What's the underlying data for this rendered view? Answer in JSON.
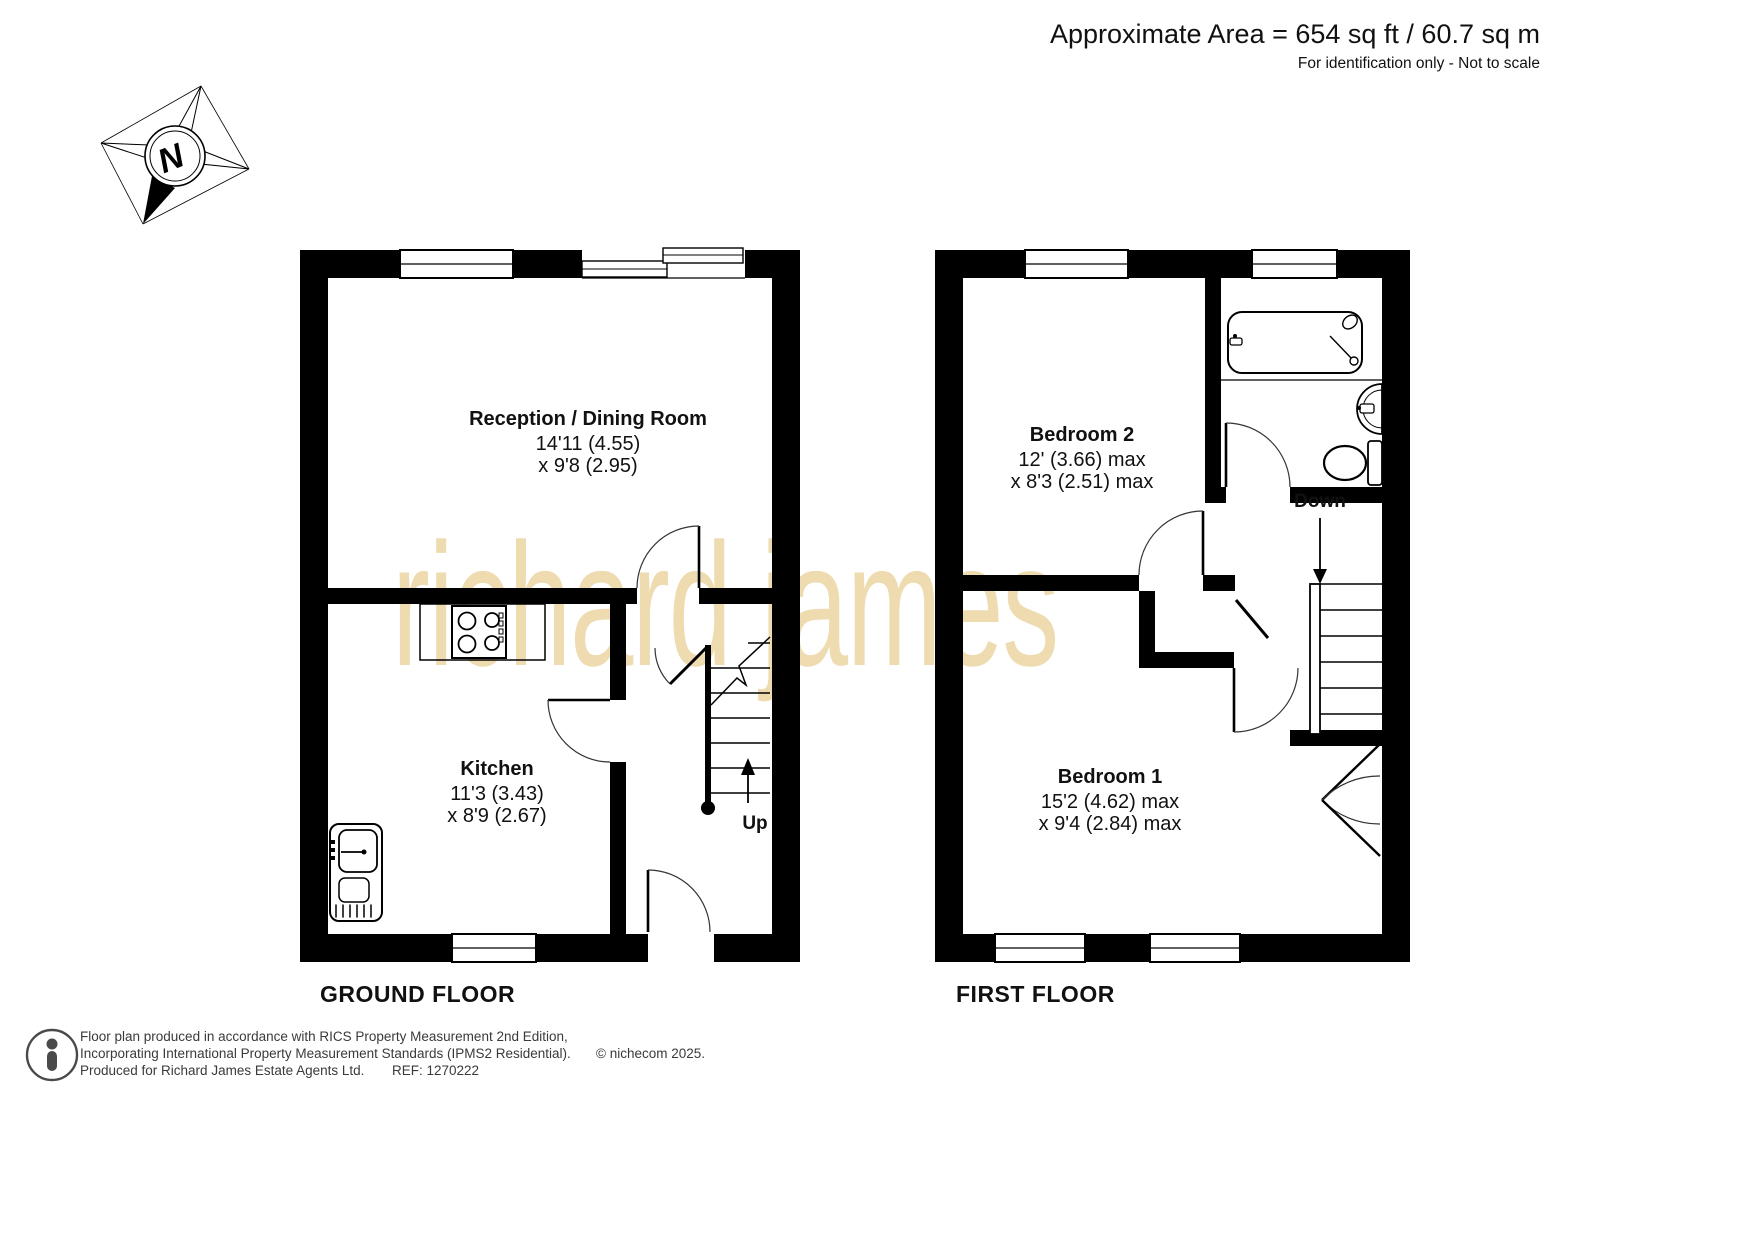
{
  "header": {
    "area": "Approximate Area = 654 sq ft / 60.7 sq m",
    "note": "For identification only - Not to scale"
  },
  "compass": {
    "label": "N"
  },
  "watermark": "richard james",
  "ground_floor": {
    "label": "GROUND FLOOR",
    "stair_label": "Up",
    "reception": {
      "name": "Reception / Dining Room",
      "dim_line1": "14'11 (4.55)",
      "dim_line2": "x 9'8 (2.95)"
    },
    "kitchen": {
      "name": "Kitchen",
      "dim_line1": "11'3 (3.43)",
      "dim_line2": "x 8'9 (2.67)"
    },
    "fixtures": [
      "hob-icon",
      "kitchen-sink-icon",
      "staircase-up",
      "entrance-door"
    ]
  },
  "first_floor": {
    "label": "FIRST FLOOR",
    "stair_label": "Down",
    "bedroom2": {
      "name": "Bedroom 2",
      "dim_line1": "12' (3.66) max",
      "dim_line2": "x 8'3 (2.51) max"
    },
    "bedroom1": {
      "name": "Bedroom 1",
      "dim_line1": "15'2 (4.62) max",
      "dim_line2": "x 9'4 (2.84) max"
    },
    "fixtures": [
      "bathtub-icon",
      "shower-head-icon",
      "wash-basin-icon",
      "toilet-icon",
      "staircase-down",
      "airing-cupboard",
      "wardrobe-doors"
    ]
  },
  "footer": {
    "line1": "Floor plan produced in accordance with RICS Property Measurement 2nd Edition,",
    "line2": "Incorporating International Property Measurement Standards (IPMS2 Residential).",
    "copyright": "© nichecom 2025.",
    "line3": "Produced for Richard James Estate Agents Ltd.",
    "ref": "REF: 1270222"
  },
  "colors": {
    "wall": "#000000",
    "watermark": "#eedbb0",
    "text": "#111111"
  }
}
